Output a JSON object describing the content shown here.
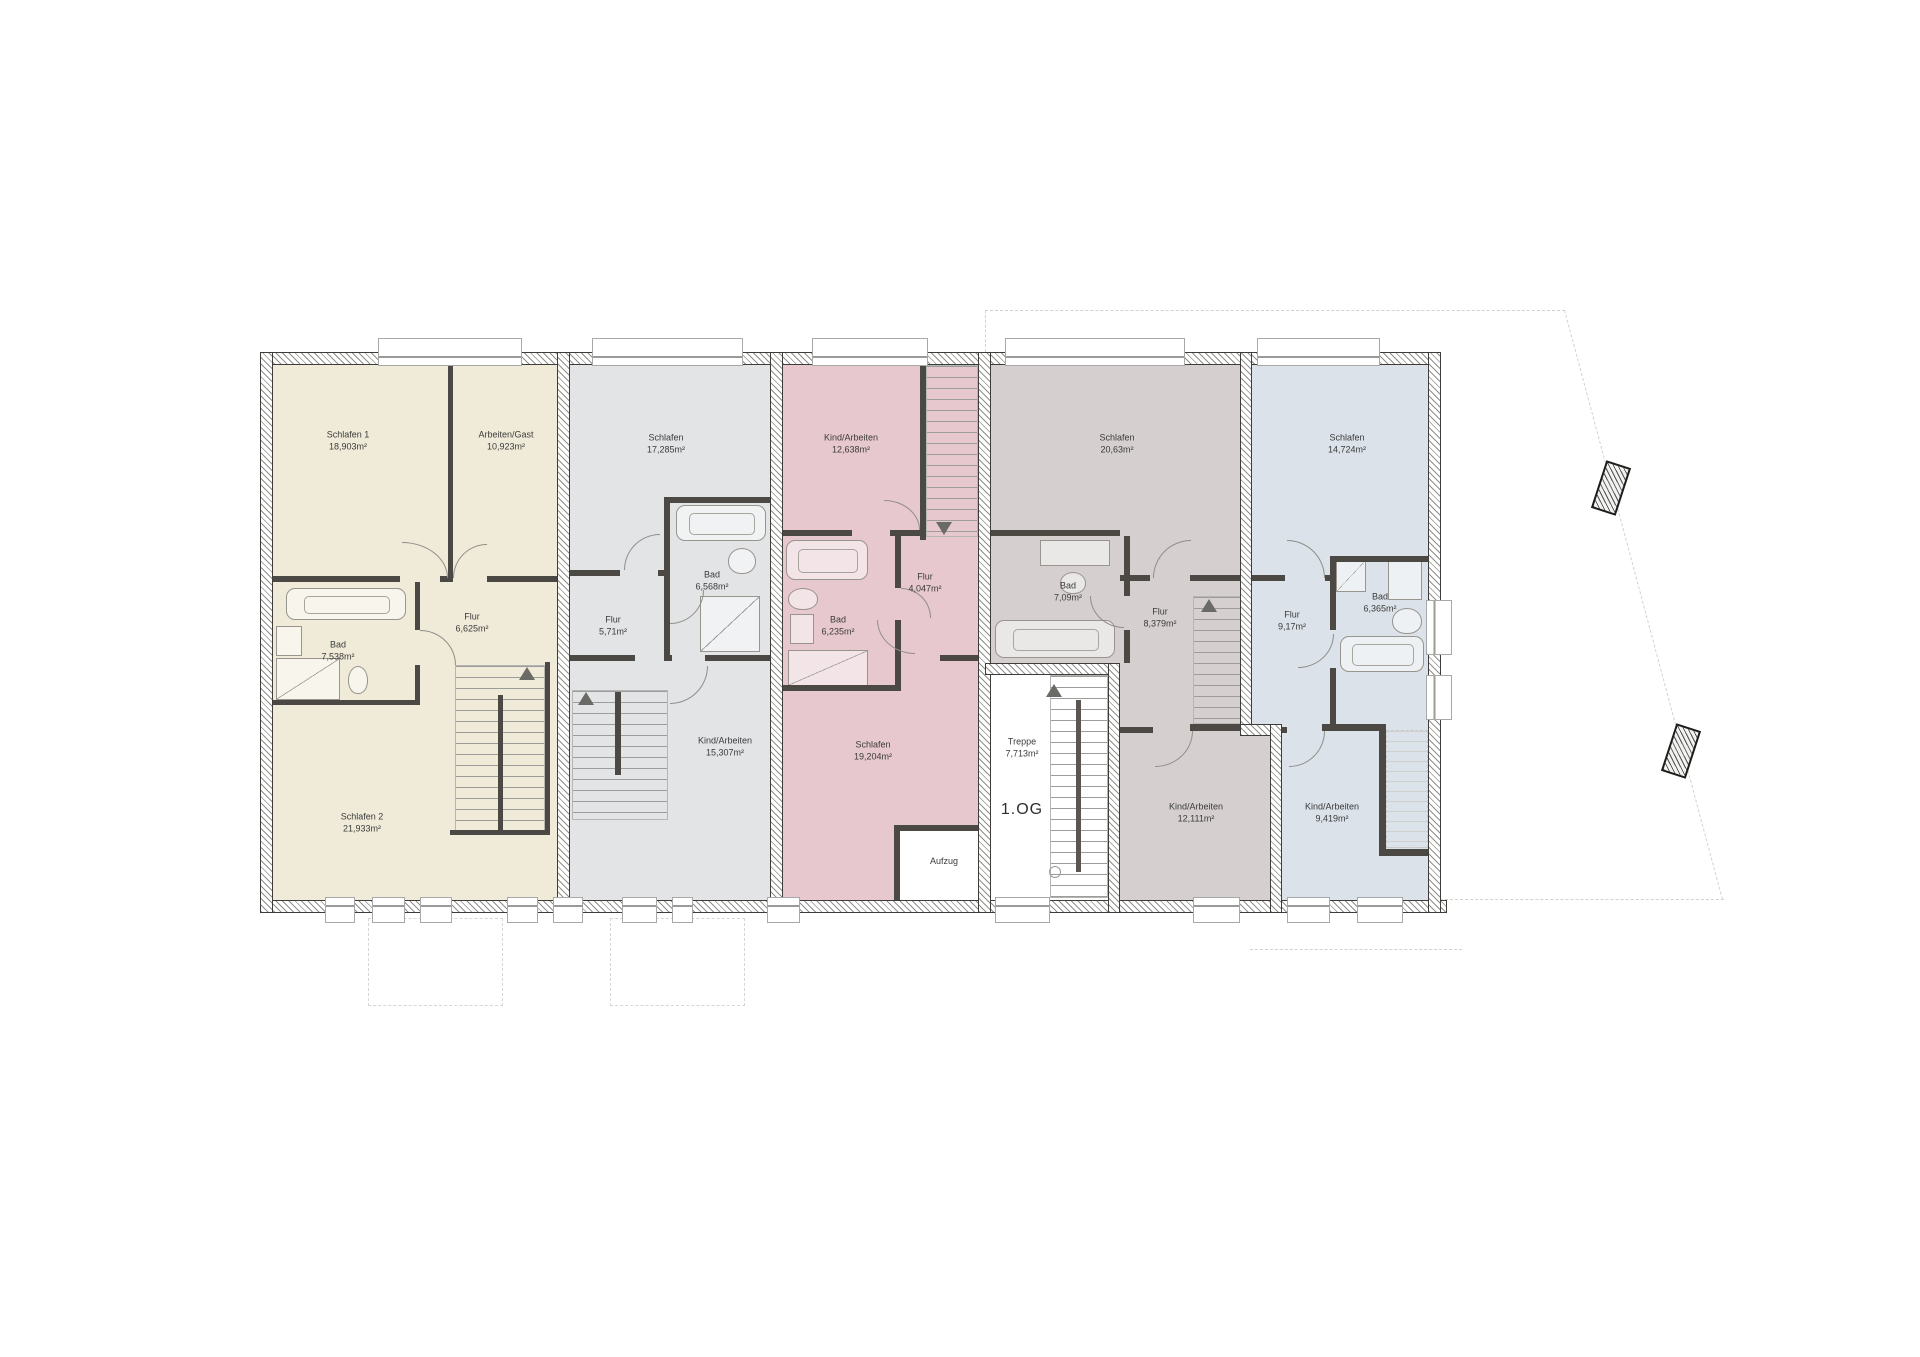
{
  "floor": {
    "label": "1.OG"
  },
  "core": {
    "treppe": {
      "name": "Treppe",
      "area": "7,713m²"
    },
    "aufzug": {
      "label": "Aufzug"
    }
  },
  "units": [
    {
      "id": "unit-1",
      "color": "#f0ebd8",
      "rooms": [
        {
          "name": "Schlafen 1",
          "area": "18,903m²"
        },
        {
          "name": "Arbeiten/Gast",
          "area": "10,923m²"
        },
        {
          "name": "Bad",
          "area": "7,538m²"
        },
        {
          "name": "Flur",
          "area": "6,625m²"
        },
        {
          "name": "Schlafen 2",
          "area": "21,933m²"
        }
      ]
    },
    {
      "id": "unit-2",
      "color": "#e3e4e6",
      "rooms": [
        {
          "name": "Schlafen",
          "area": "17,285m²"
        },
        {
          "name": "Bad",
          "area": "6,568m²"
        },
        {
          "name": "Flur",
          "area": "5,71m²"
        },
        {
          "name": "Kind/Arbeiten",
          "area": "15,307m²"
        }
      ]
    },
    {
      "id": "unit-3",
      "color": "#e7c8ce",
      "rooms": [
        {
          "name": "Kind/Arbeiten",
          "area": "12,638m²"
        },
        {
          "name": "Flur",
          "area": "4,047m²"
        },
        {
          "name": "Bad",
          "area": "6,235m²"
        },
        {
          "name": "Schlafen",
          "area": "19,204m²"
        }
      ]
    },
    {
      "id": "unit-4",
      "color": "#d5d0cf",
      "rooms": [
        {
          "name": "Schlafen",
          "area": "20,63m²"
        },
        {
          "name": "Bad",
          "area": "7,09m²"
        },
        {
          "name": "Flur",
          "area": "8,379m²"
        },
        {
          "name": "Kind/Arbeiten",
          "area": "12,111m²"
        }
      ]
    },
    {
      "id": "unit-5",
      "color": "#dbe2e9",
      "rooms": [
        {
          "name": "Schlafen",
          "area": "14,724m²"
        },
        {
          "name": "Bad",
          "area": "6,365m²"
        },
        {
          "name": "Flur",
          "area": "9,17m²"
        },
        {
          "name": "Kind/Arbeiten",
          "area": "9,419m²"
        }
      ]
    }
  ]
}
